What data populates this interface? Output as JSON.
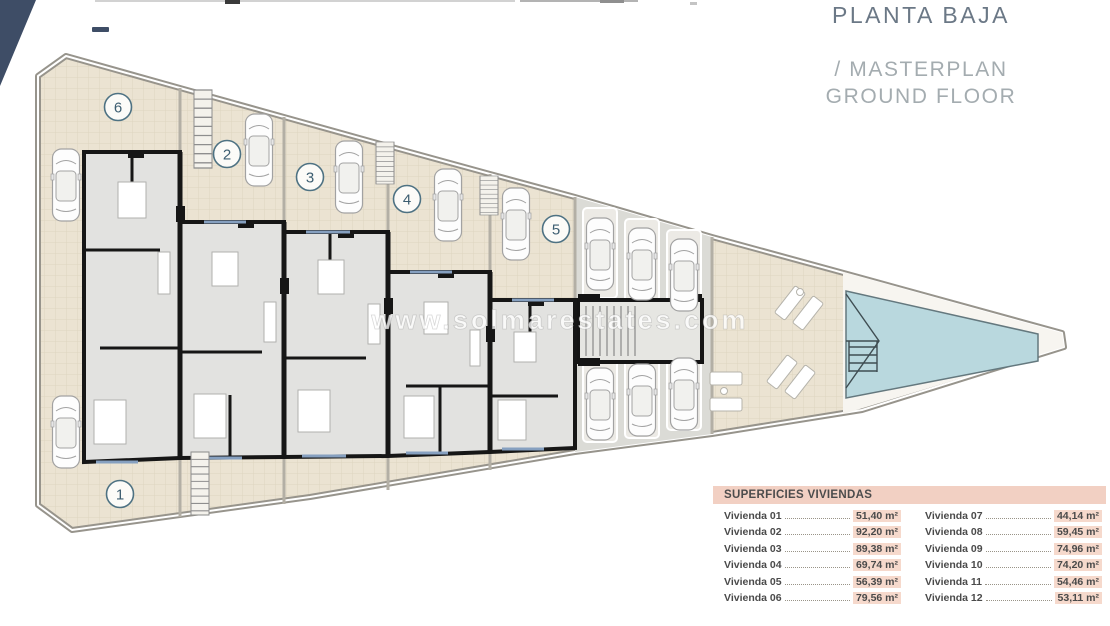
{
  "header": {
    "title_primary": "PLANTA BAJA",
    "title_secondary_line1": "/ MASTERPLAN",
    "title_secondary_line2": "GROUND FLOOR"
  },
  "watermark": "www.solmarestates.com",
  "plan": {
    "units": [
      {
        "label": "1"
      },
      {
        "label": "2"
      },
      {
        "label": "3"
      },
      {
        "label": "4"
      },
      {
        "label": "5"
      },
      {
        "label": "6"
      }
    ]
  },
  "table": {
    "title": "SUPERFICIES VIVIENDAS",
    "left": [
      {
        "name": "Vivienda 01",
        "area": "51,40 m²"
      },
      {
        "name": "Vivienda 02",
        "area": "92,20 m²"
      },
      {
        "name": "Vivienda 03",
        "area": "89,38 m²"
      },
      {
        "name": "Vivienda 04",
        "area": "69,74 m²"
      },
      {
        "name": "Vivienda 05",
        "area": "56,39 m²"
      },
      {
        "name": "Vivienda 06",
        "area": "79,56 m²"
      }
    ],
    "right": [
      {
        "name": "Vivienda 07",
        "area": "44,14 m²"
      },
      {
        "name": "Vivienda 08",
        "area": "59,45 m²"
      },
      {
        "name": "Vivienda 09",
        "area": "74,96 m²"
      },
      {
        "name": "Vivienda 10",
        "area": "74,20 m²"
      },
      {
        "name": "Vivienda 11",
        "area": "54,46 m²"
      },
      {
        "name": "Vivienda 12",
        "area": "53,11 m²"
      }
    ]
  },
  "colors": {
    "corner_navy": "#3e4d66",
    "terrace_beige": "#ebe3d2",
    "pool_blue": "#b9d8de",
    "accent_pink": "#f2d0c3",
    "value_highlight": "#f6d9cc",
    "title_slate": "#6b7886",
    "title_gray": "#a4acb0"
  }
}
